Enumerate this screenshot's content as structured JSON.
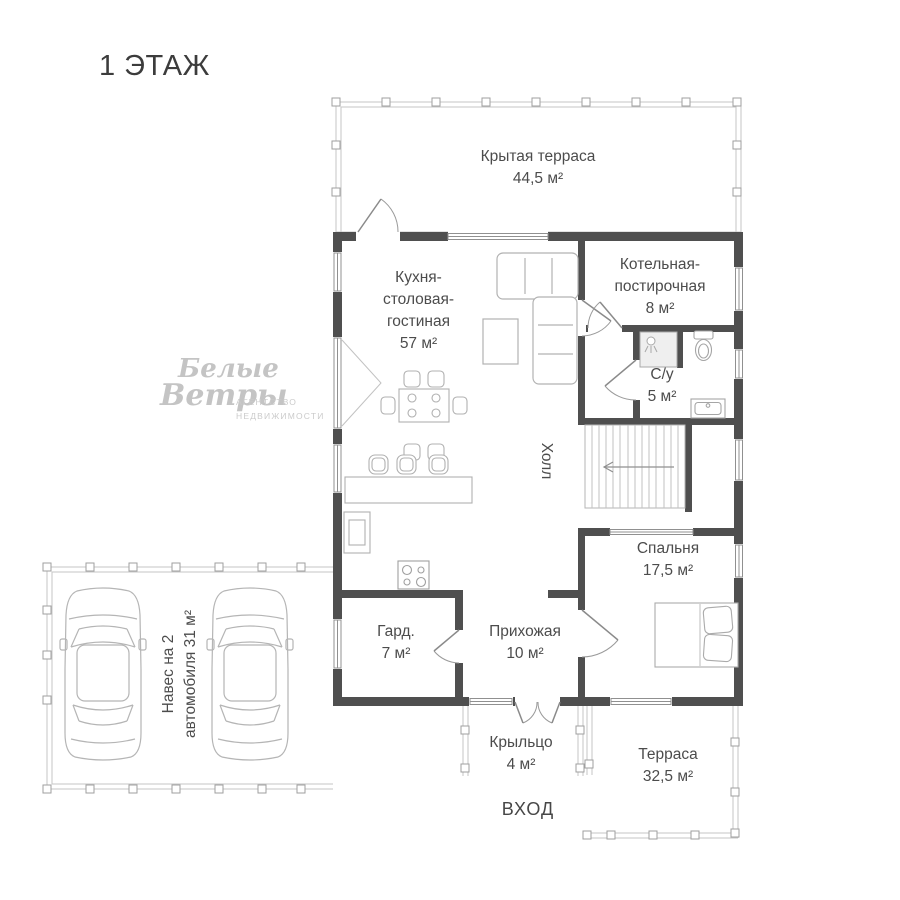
{
  "title": "1 ЭТАЖ",
  "watermark": {
    "word1": "Белые",
    "word2": "Ветры",
    "tagline_line1": "АГЕНТСТВО",
    "tagline_line2": "НЕДВИЖИМОСТИ"
  },
  "rooms": {
    "covered_terrace": {
      "name": "Крытая терраса",
      "area": "44,5 м²"
    },
    "kitchen_living": {
      "name": "Кухня-столовая-гостиная",
      "area": "57 м²"
    },
    "boiler_laundry": {
      "name": "Котельная-постирочная",
      "area": "8 м²"
    },
    "bathroom": {
      "name": "С/у",
      "area": "5 м²"
    },
    "hall": {
      "name": "Холл"
    },
    "bedroom": {
      "name": "Спальня",
      "area": "17,5 м²"
    },
    "wardrobe": {
      "name": "Гард.",
      "area": "7 м²"
    },
    "hallway": {
      "name": "Прихожая",
      "area": "10 м²"
    },
    "porch": {
      "name": "Крыльцо",
      "area": "4 м²"
    },
    "terrace": {
      "name": "Терраса",
      "area": "32,5 м²"
    },
    "carport": {
      "line1": "Навес на 2",
      "line2": "автомобиля 31 м²"
    }
  },
  "entrance": {
    "label": "ВХОД"
  },
  "colors": {
    "wall": "#4f4f4f",
    "thin_line": "#c6c6c6",
    "furniture_line": "#b2b2b2",
    "label_text": "#4c4c4c",
    "watermark": "#c4c4c4"
  }
}
